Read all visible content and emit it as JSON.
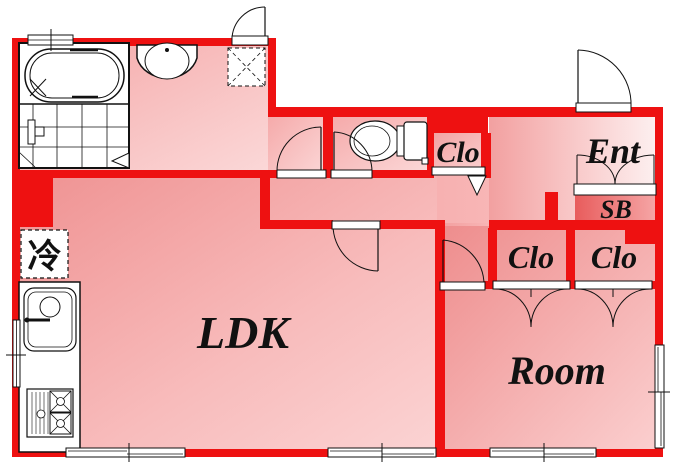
{
  "plan": {
    "rooms": {
      "ldk": {
        "label": "LDK"
      },
      "bedroom": {
        "label": "Room"
      },
      "entrance": {
        "label": "Ent"
      },
      "shoe_box": {
        "label": "SB"
      },
      "closet_hall": {
        "label": "Clo"
      },
      "closet_left": {
        "label": "Clo"
      },
      "closet_right": {
        "label": "Clo"
      },
      "refrigerator_space": {
        "label": "冷"
      }
    },
    "fixtures": [
      "bathtub-icon",
      "shower-floor-icon",
      "washbasin-icon",
      "washing-machine-pan-icon",
      "toilet-icon",
      "kitchen-sink-icon",
      "gas-stove-icon",
      "refrigerator-space-icon"
    ],
    "colors": {
      "wall": "#ee1111",
      "line": "#111111",
      "floor_dark": "#ef9090",
      "floor_light": "#fbd6d6",
      "entrance_light": "#fdf0f0",
      "shoebox_dark": "#e85c5c"
    }
  }
}
